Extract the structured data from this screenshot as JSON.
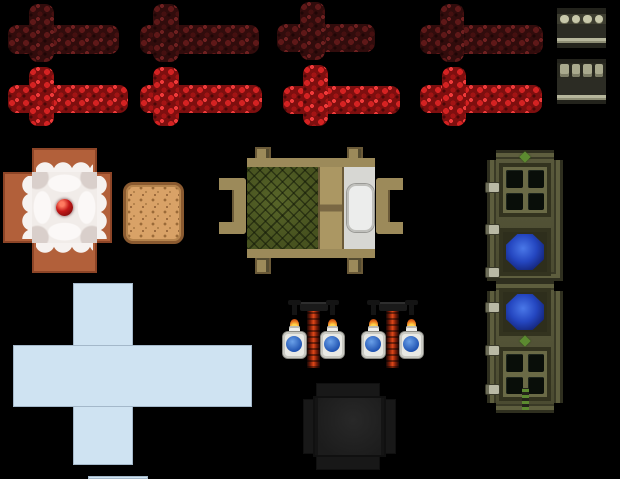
{
  "canvas": {
    "width": 620,
    "height": 479,
    "background": "#000000"
  },
  "atlas": {
    "kind": "minecraft-style-texture-sprite-sheet",
    "sprites": [
      {
        "name": "redstone-dust-unpowered",
        "count": 4,
        "base_color": "#310c0c",
        "spot_color": "#5e1818"
      },
      {
        "name": "redstone-dust-powered",
        "count": 4,
        "base_color": "#7e0f0f",
        "spot_color": "#d42222"
      },
      {
        "name": "piston-side-block-top",
        "body_color": "#303027",
        "knob_color": "#c8c8aa",
        "stripe_color": "#b6b69c"
      },
      {
        "name": "piston-side-block-bottom",
        "body_color": "#303027",
        "knob_color": "#a9a98d",
        "stripe_color": "#b6b69c"
      },
      {
        "name": "cake-cross",
        "side_color": "#b2603a",
        "icing_color": "#f3efed",
        "cherry_color": "#c41818"
      },
      {
        "name": "cake-sponge-square",
        "color": "#d9a267",
        "speckle_color": "#9a6a38"
      },
      {
        "name": "bed-top-texture",
        "frame_color": "#9c8a5a",
        "blanket_color": "#47521f",
        "pillow_color": "#ecedec"
      },
      {
        "name": "door-upper-half",
        "frame_color": "#505034",
        "pane_color": "#090e09",
        "glass_color": "#2446c0",
        "hinge_color": "#b9b9a5"
      },
      {
        "name": "door-lower-half",
        "frame_color": "#505034",
        "pane_color": "#090e09",
        "glass_color": "#2446c0",
        "hinge_color": "#b9b9a5"
      },
      {
        "name": "light-blue-plus-cross",
        "color": "#cfe3f2"
      },
      {
        "name": "light-blue-plus-cross-partial",
        "color": "#cfe3f2"
      },
      {
        "name": "brewing-stand",
        "count": 2,
        "potion_color": "#2a62c8",
        "glow_color": "#e04818",
        "flame_color": "#e8701c"
      },
      {
        "name": "cauldron-dark-block",
        "color": "#1f1f1f"
      }
    ]
  }
}
